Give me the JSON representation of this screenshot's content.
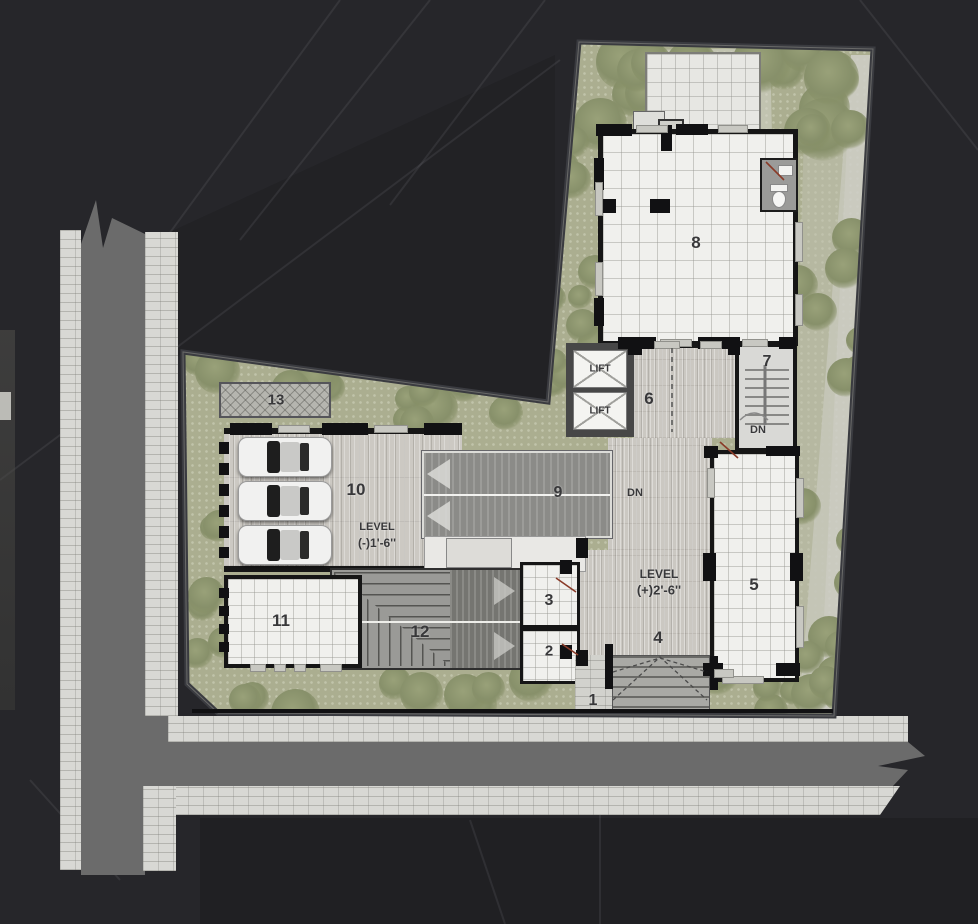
{
  "plan": {
    "type": "architectural-site-floor-plan",
    "labels": {
      "rooms": [
        {
          "id": "room-1",
          "text": "1"
        },
        {
          "id": "room-2",
          "text": "2"
        },
        {
          "id": "room-3",
          "text": "3"
        },
        {
          "id": "room-4",
          "text": "4"
        },
        {
          "id": "room-5",
          "text": "5"
        },
        {
          "id": "room-6",
          "text": "6"
        },
        {
          "id": "room-7",
          "text": "7"
        },
        {
          "id": "room-8",
          "text": "8"
        },
        {
          "id": "room-9",
          "text": "9"
        },
        {
          "id": "room-10",
          "text": "10"
        },
        {
          "id": "room-11",
          "text": "11"
        },
        {
          "id": "room-12",
          "text": "12"
        },
        {
          "id": "room-13",
          "text": "13"
        }
      ],
      "lifts": [
        "LIFT",
        "LIFT"
      ],
      "stair_dn": "DN",
      "ramp_dn": "DN",
      "level_parking": {
        "line1": "LEVEL",
        "line2": "(-)1'-6''"
      },
      "level_entrance": {
        "line1": "LEVEL",
        "line2": "(+)2'-6''"
      }
    },
    "colors": {
      "garden": "#abae90",
      "tree": "#8a9268",
      "tile": "#f0f0ed",
      "wood": "#cbc8c2",
      "ramp": "#8f8f8c",
      "road": "#6b6b6b",
      "sidewalk": "#d8d8d4",
      "wall": "#161616",
      "boundary": "#3a3b40",
      "hatch": "#b5b5af",
      "label": "#38383a",
      "door": "#8a3b28",
      "liftwall": "#474747"
    }
  }
}
